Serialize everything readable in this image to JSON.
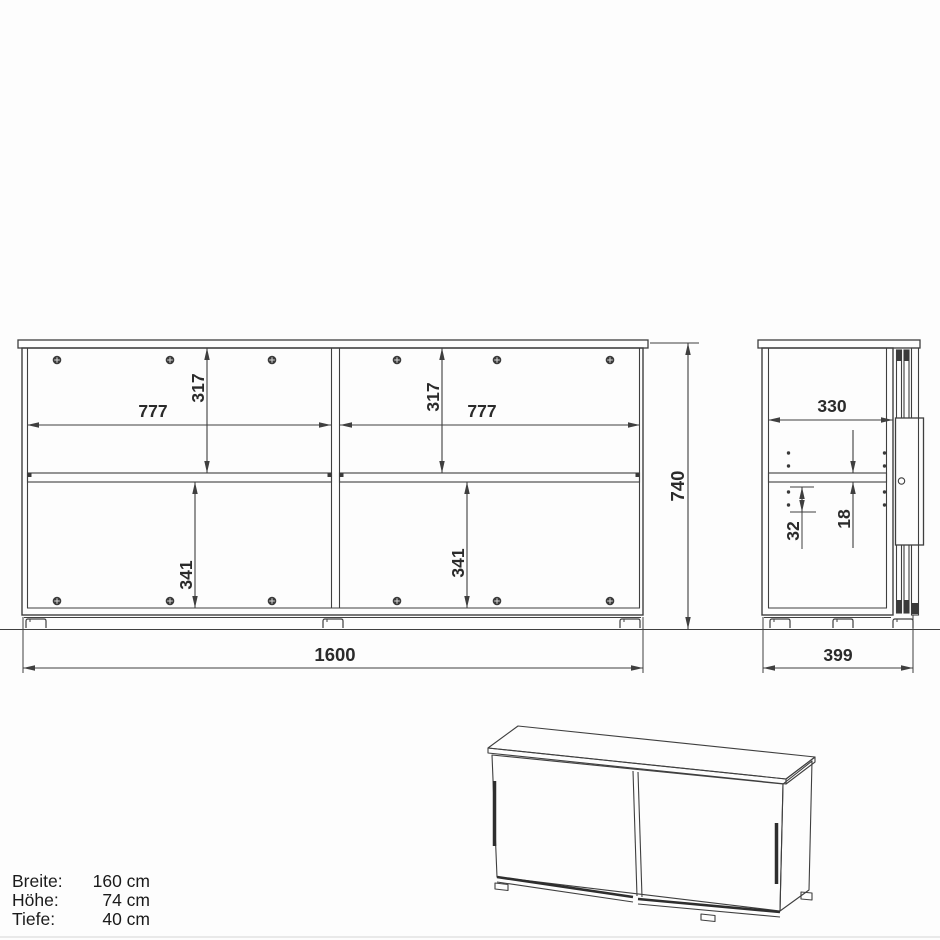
{
  "drawing": {
    "kind": "furniture technical drawing - sideboard with sliding doors",
    "views": {
      "front": "front elevation",
      "side": "side elevation",
      "perspective": "3d perspective sketch"
    }
  },
  "front_view": {
    "dims": {
      "inner_width_left": "777",
      "inner_width_right": "777",
      "upper_height_left": "317",
      "upper_height_right": "317",
      "lower_height_left": "341",
      "lower_height_right": "341",
      "overall_width": "1600",
      "overall_height": "740"
    }
  },
  "side_view": {
    "dims": {
      "inner_depth": "330",
      "hole_pitch": "32",
      "shelf_thickness": "18",
      "overall_depth": "399"
    }
  },
  "specs": {
    "rows": [
      {
        "label": "Breite:",
        "value": "160 cm"
      },
      {
        "label": "Höhe:",
        "value": "74 cm"
      },
      {
        "label": "Tiefe:",
        "value": "40 cm"
      }
    ]
  },
  "icons": {
    "screw_head": "screw-head-icon",
    "shelf_pin_holes": "shelf-pin-hole-dots"
  },
  "colors": {
    "line": "#3f3f3f",
    "text": "#2b2b2b",
    "background": "#fdfdfd"
  }
}
